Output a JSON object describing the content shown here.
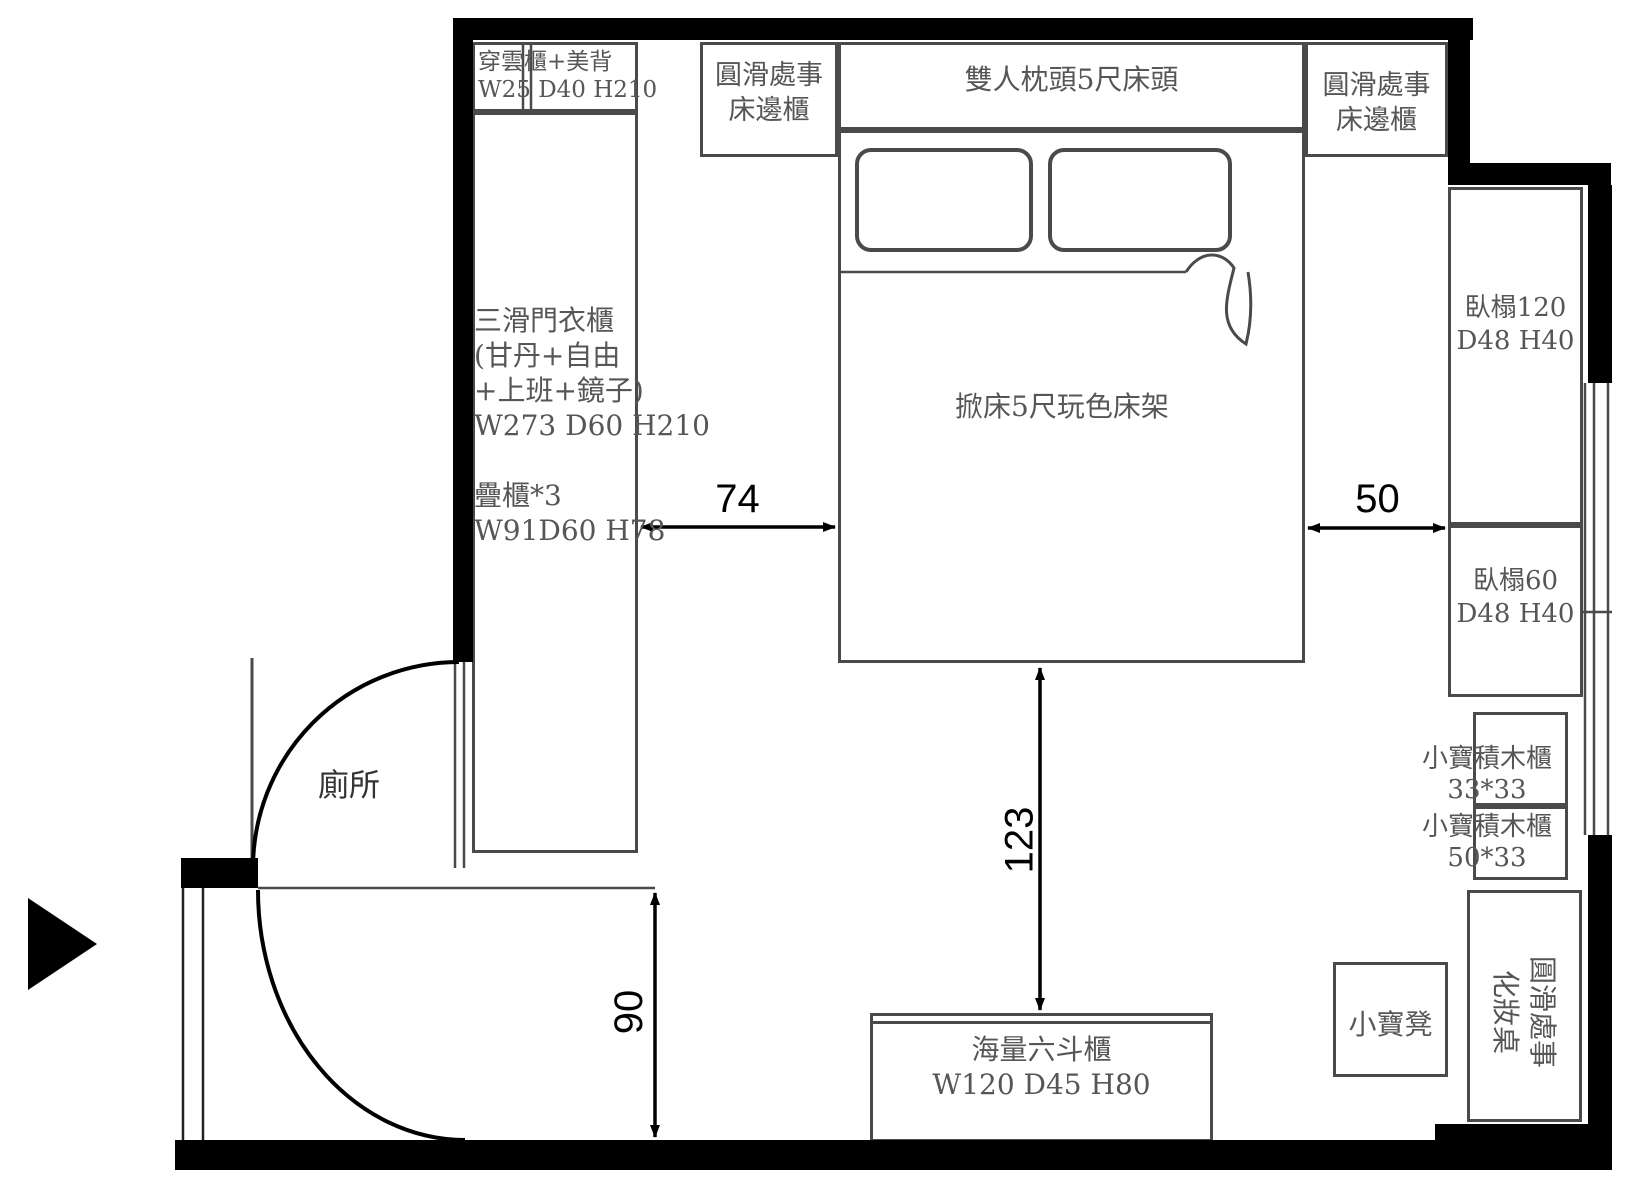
{
  "labels": {
    "toilet": "廁所",
    "top_cabinet_1": "穿雲櫃+美背",
    "top_cabinet_2": "W25 D40 H210",
    "bedside_left": [
      "圓滑處事",
      "床邊櫃"
    ],
    "headboard": "雙人枕頭5尺床頭",
    "bedside_right": [
      "圓滑處事",
      "床邊櫃"
    ],
    "wardrobe": [
      "三滑門衣櫃",
      "(甘丹+自由",
      "+上班+鏡子)",
      "W273 D60 H210",
      "疊櫃*3",
      "W91D60 H78"
    ],
    "bed": "掀床5尺玩色床架",
    "daybed120": [
      "臥榻120",
      "D48 H40"
    ],
    "daybed60": [
      "臥榻60",
      "D48 H40"
    ],
    "blocks_cabinet_1": [
      "小寶積木櫃",
      "33*33"
    ],
    "blocks_cabinet_2": [
      "小寶積木櫃",
      "50*33"
    ],
    "dresser": [
      "海量六斗櫃",
      "W120 D45 H80"
    ],
    "stool": "小寶凳",
    "vanity": [
      "圓滑處事",
      "化妝桌"
    ]
  },
  "dimensions": {
    "gap_wardrobe_bed": "74",
    "gap_bed_daybed": "50",
    "gap_bed_dresser": "123",
    "corridor_width": "90"
  },
  "colors": {
    "wall": "#000000",
    "furniture_line": "#4a4a4a",
    "label_text": "#565656",
    "dimension_text": "#000000"
  }
}
